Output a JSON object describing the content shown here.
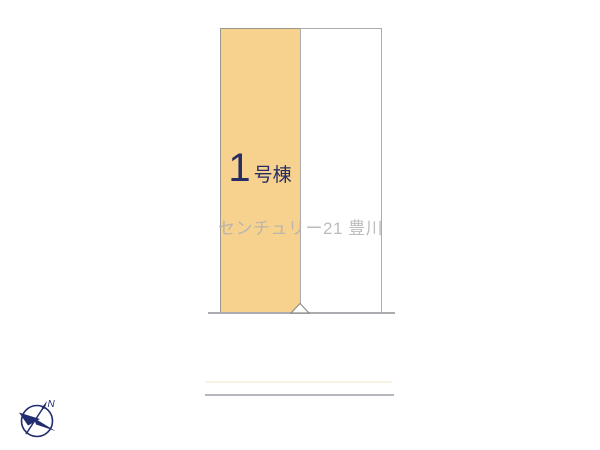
{
  "site_plan": {
    "building": {
      "number": "1",
      "suffix": "号棟"
    },
    "lot_count": 2,
    "boundary_marker": "triangle",
    "colors": {
      "lot_fill": "#F6D28E",
      "lot_border": "#98988E",
      "label_navy": "#272C63",
      "watermark_gray": "#B0B0B0",
      "boundary_gray": "#ABABB0",
      "road_edge_gray": "#B6B6BE",
      "compass_navy": "#212D6E",
      "background": "#FFFFFF"
    }
  },
  "watermark": {
    "text": "センチュリー21 豊川"
  },
  "compass": {
    "north_label": "N"
  }
}
